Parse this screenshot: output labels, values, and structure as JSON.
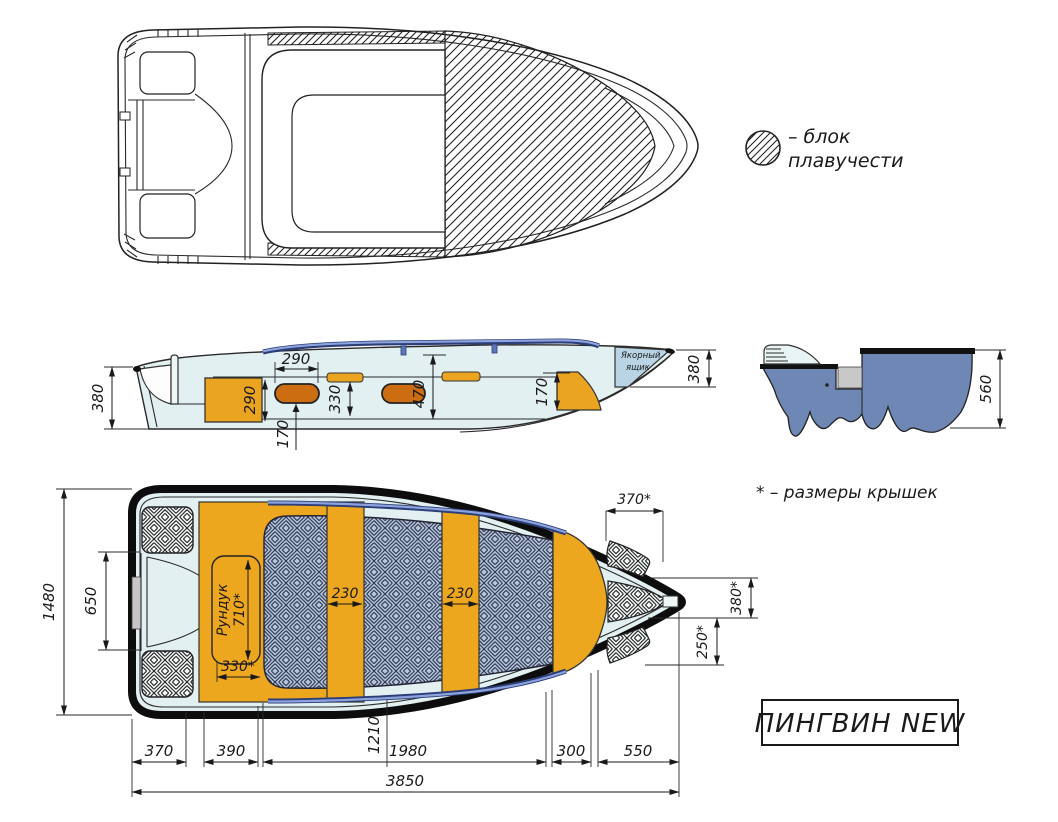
{
  "legend": {
    "line1": "– блок",
    "line2": "плавучести"
  },
  "note_covers": "* – размеры крышек",
  "model_name": "ПИНГВИН NEW",
  "side": {
    "transom_height": "380",
    "locker_height": "290",
    "seat_width": "290",
    "seat_clearance": "170",
    "gunwale_to_floor": "330",
    "cockpit_depth": "470",
    "bow_locker_height": "170",
    "anchor_box_line1": "Якорный",
    "anchor_box_line2": "ящик",
    "bow_height": "380"
  },
  "section": {
    "transom_depth": "560"
  },
  "plan": {
    "beam": "1480",
    "transom_width": "650",
    "bow_hatch_width": "370*",
    "bow_hatch_height": "380*",
    "bow_hatch_depth": "250*",
    "locker_label": "Рундук",
    "locker_length": "710*",
    "locker_width": "330*",
    "thwart1_width": "230",
    "thwart2_width": "230",
    "chain_370": "370",
    "chain_390": "390",
    "chain_1210": "1210",
    "chain_1980": "1980",
    "chain_300": "300",
    "chain_550": "550",
    "overall_length": "3850"
  },
  "colors": {
    "hull_fill": "#e3f0f1",
    "seat_orange": "#eda71f",
    "pill_orange": "#cd6d12",
    "rail_blue": "#5c76bb",
    "floor_base": "#b9c4d6",
    "floor_lines": "#2e3d5c",
    "section_hull": "#6e87b5",
    "anchor_box": "#b9d4e4",
    "outline": "#1a1a1a"
  }
}
